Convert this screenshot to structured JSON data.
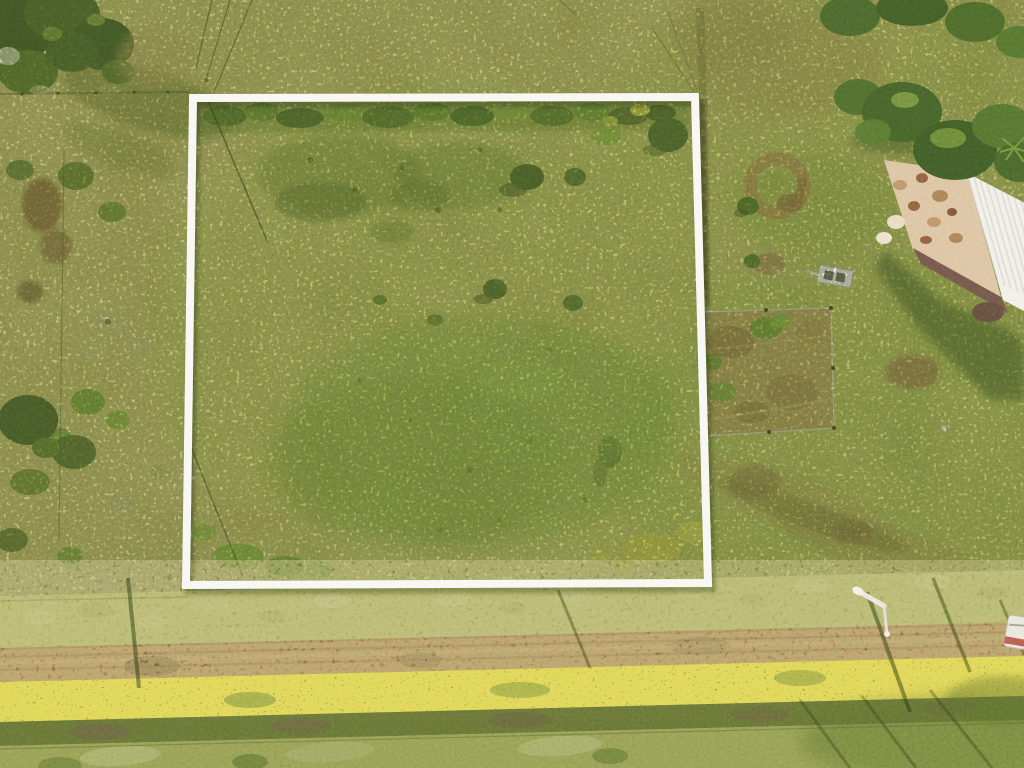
{
  "meta": {
    "title": "Aerial drone photograph of a rural land parcel outlined with a white boundary square",
    "width": 1024,
    "height": 768
  },
  "scene": {
    "description": "Top-down aerial photo of grassy acreage. A white square outline marks a vacant lot in the left-center. A dirt road with grassy verges and a yellow-flowering hedgerow crosses the bottom. A white-roofed farmhouse with a tan deck sits at upper right among trees. A fenced garden plot, a round dirt patch and a small white trailer lie east of the lot. Power-line and pole shadows cross the field and road.",
    "lot_boundary": {
      "corners": [
        [
          193,
          98
        ],
        [
          695,
          97
        ],
        [
          708,
          583
        ],
        [
          186,
          585
        ]
      ],
      "stroke_width": 8
    },
    "dirt_road": {
      "top_edge": [
        [
          0,
          648
        ],
        [
          1024,
          622
        ]
      ],
      "bottom_edge": [
        [
          0,
          684
        ],
        [
          1024,
          658
        ]
      ]
    },
    "flower_band": {
      "top_edge": [
        [
          0,
          682
        ],
        [
          1024,
          656
        ]
      ],
      "bottom_edge": [
        [
          0,
          722
        ],
        [
          1024,
          696
        ]
      ]
    },
    "farmhouse": {
      "deck": [
        [
          884,
          160
        ],
        [
          967,
          172
        ],
        [
          1001,
          297
        ],
        [
          913,
          250
        ]
      ],
      "white_roof": [
        [
          967,
          173
        ],
        [
          1023,
          202
        ],
        [
          1024,
          311
        ],
        [
          1003,
          300
        ]
      ],
      "dark_roof": [
        [
          913,
          248
        ],
        [
          1001,
          297
        ],
        [
          1008,
          313
        ],
        [
          921,
          264
        ]
      ]
    },
    "garden_enclosure": [
      [
        702,
        312
      ],
      [
        831,
        308
      ],
      [
        834,
        428
      ],
      [
        704,
        436
      ]
    ],
    "dirt_circle": {
      "center": [
        777,
        186
      ],
      "radius": 27
    },
    "dirt_patch_small": {
      "center": [
        769,
        264
      ]
    },
    "white_trailer": {
      "center": [
        835,
        277
      ]
    },
    "street_light": {
      "arm": [
        [
          860,
          592
        ],
        [
          884,
          606
        ]
      ],
      "base": [
        886,
        634
      ]
    },
    "vehicle_at_edge": {
      "position": [
        1013,
        630
      ]
    }
  },
  "palette": {
    "grass_base": "#a3a355",
    "grass_light": "#b5ad63",
    "grass_green": "#8ca348",
    "lot_grass": "#9da84f",
    "scrub_dark": "#6f7f3a",
    "tree_dark": "#47602a",
    "tree_mid": "#5a7530",
    "bush_bright": "#7fa03c",
    "dry_brown": "#9c8350",
    "dirt_brown": "#8a6f42",
    "road": "#a27b4c",
    "road_track": "#7d5c38",
    "flower_yellow": "#e0d456",
    "flower_band": "#8f9a42",
    "dark_band": "#5e6a31",
    "bottom_band": "#8e9950",
    "shadow": "#2f3a18",
    "frame_white": "#f8f6f1",
    "frame_shadow": "#1f2a10",
    "roof_white": "#f0eee7",
    "roof_ridge": "#d8d5cb",
    "roof_brown": "#6d5347",
    "deck_tan": "#d9c09b",
    "garden_fill": "#a8955a",
    "fence_wire": "#d8d4c4",
    "pole_white": "#e9e6da",
    "vehicle_red": "#b0483c"
  }
}
